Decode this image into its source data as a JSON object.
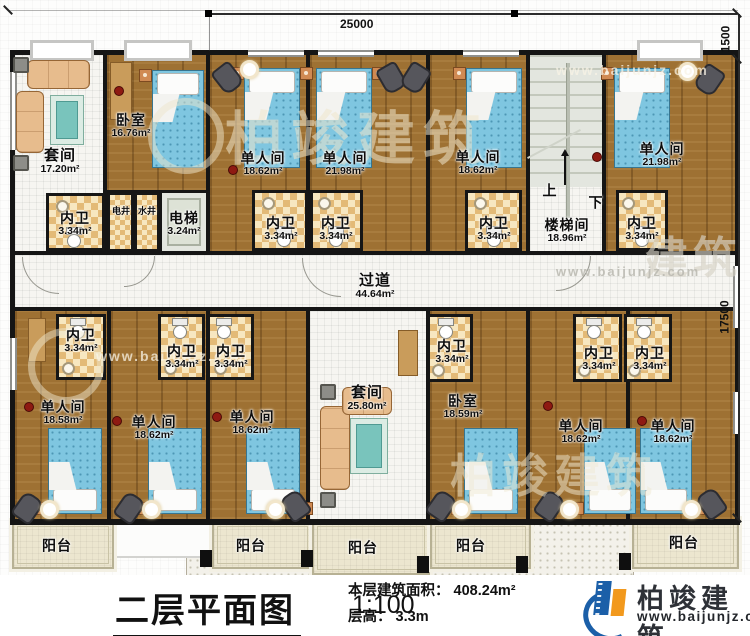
{
  "dimensions": {
    "top": "25000",
    "right_top": "1500",
    "right_side": "17500"
  },
  "rooms": {
    "suite_tl": {
      "name": "套间",
      "area": "17.20m²"
    },
    "bedroom_tl": {
      "name": "卧室",
      "area": "16.76m²"
    },
    "bath_tl": {
      "name": "内卫",
      "area": "3.34m²"
    },
    "shaft_elec": {
      "name": "电井"
    },
    "shaft_water": {
      "name": "水井"
    },
    "elevator": {
      "name": "电梯",
      "area": "3.24m²"
    },
    "single_t1": {
      "name": "单人间",
      "area": "18.62m²"
    },
    "single_t2": {
      "name": "单人间",
      "area": "21.98m²"
    },
    "bath_t1": {
      "name": "内卫",
      "area": "3.34m²"
    },
    "bath_t2": {
      "name": "内卫",
      "area": "3.34m²"
    },
    "single_t3": {
      "name": "单人间",
      "area": "18.62m²"
    },
    "bath_t3": {
      "name": "内卫",
      "area": "3.34m²"
    },
    "stairwell": {
      "name": "楼梯间",
      "area": "18.96m²",
      "up": "上",
      "down": "下"
    },
    "single_t4": {
      "name": "单人间",
      "area": "21.98m²"
    },
    "bath_t4": {
      "name": "内卫",
      "area": "3.34m²"
    },
    "corridor": {
      "name": "过道",
      "area": "44.64m²"
    },
    "bath_b1": {
      "name": "内卫",
      "area": "3.34m²"
    },
    "single_b1": {
      "name": "单人间",
      "area": "18.58m²"
    },
    "bath_b2": {
      "name": "内卫",
      "area": "3.34m²"
    },
    "bath_b3": {
      "name": "内卫",
      "area": "3.34m²"
    },
    "single_b2": {
      "name": "单人间",
      "area": "18.62m²"
    },
    "single_b3": {
      "name": "单人间",
      "area": "18.62m²"
    },
    "suite_b": {
      "name": "套间",
      "area": "25.80m²"
    },
    "bath_b4": {
      "name": "内卫",
      "area": "3.34m²"
    },
    "bedroom_b": {
      "name": "卧室",
      "area": "18.59m²"
    },
    "bath_b5": {
      "name": "内卫",
      "area": "3.34m²"
    },
    "bath_b6": {
      "name": "内卫",
      "area": "3.34m²"
    },
    "single_b4": {
      "name": "单人间",
      "area": "18.62m²"
    },
    "single_b5": {
      "name": "单人间",
      "area": "18.62m²"
    }
  },
  "balconies": [
    "阳台",
    "阳台",
    "阳台",
    "阳台",
    "阳台"
  ],
  "footer": {
    "title": "二层平面图",
    "scale": "1:100",
    "area_label": "本层建筑面积：",
    "area_value": "408.24m²",
    "height_label": "层高：",
    "height_value": "3.3m"
  },
  "brand": {
    "name": "柏竣建筑",
    "website": "www.baijunjz.com"
  },
  "watermark": {
    "text": "柏竣建筑",
    "partial": "建筑",
    "site": "www.baijunjz.com"
  }
}
